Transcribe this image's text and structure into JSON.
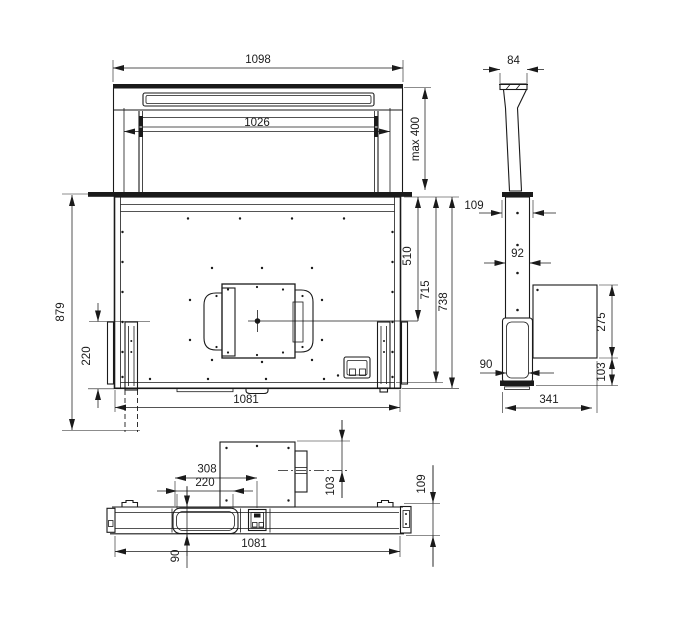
{
  "figure": {
    "background": "#ffffff",
    "line_color": "#1a1a1a",
    "description": "Dimensional technical drawing of a downdraft extractor hood, three orthographic views"
  },
  "views": {
    "front": {
      "label": "front-view",
      "dims": {
        "overall_width": "1098",
        "panel_width": "1026",
        "max_extension": "max 400",
        "overall_height": "879",
        "rail_height": "220",
        "center_depth": "510",
        "inner_height": "715",
        "body_height": "738",
        "body_width": "1081"
      }
    },
    "side": {
      "label": "side-view",
      "dims": {
        "panel_depth": "84",
        "top_frame_depth": "109",
        "column_depth": "92",
        "motor_box_height": "275",
        "bottom_offset": "103",
        "housing_depth": "90",
        "total_depth": "341"
      }
    },
    "bottom": {
      "label": "bottom-view",
      "dims": {
        "outlet_offset": "308",
        "outlet_width": "220",
        "duct_center_offset": "103",
        "base_depth": "109",
        "base_width": "1081",
        "outlet_depth": "90"
      }
    }
  }
}
